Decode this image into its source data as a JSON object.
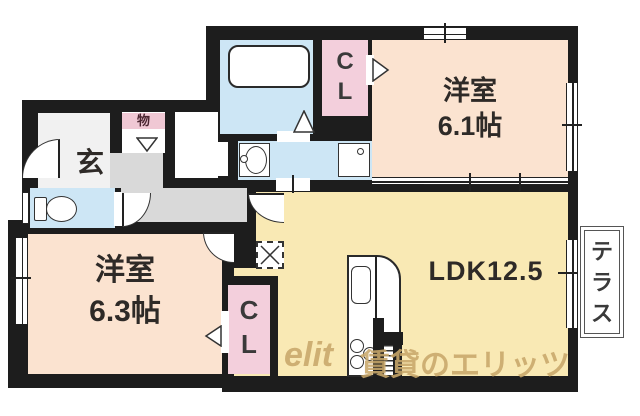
{
  "floorplan": {
    "rooms": {
      "western1": {
        "label": "洋室",
        "size": "6.1帖"
      },
      "western2": {
        "label": "洋室",
        "size": "6.3帖"
      },
      "ldk": {
        "label": "LDK12.5"
      },
      "entrance": {
        "label": "玄"
      },
      "storage": {
        "label": "物"
      },
      "closet_top": {
        "line1": "C",
        "line2": "L"
      },
      "closet_bottom": {
        "line1": "C",
        "line2": "L"
      },
      "terrace": {
        "c1": "テ",
        "c2": "ラ",
        "c3": "ス"
      }
    },
    "watermark": {
      "logo": "elit",
      "text": "賃貸のエリッツ"
    },
    "colors": {
      "wall": "#1d1d1d",
      "western_room": "#fbe3d0",
      "ldk_room": "#f9e9b4",
      "wet_area": "#cde6f5",
      "closet": "#f3cfdc",
      "hallway": "#d9d9d9",
      "watermark": "#c9a86b"
    }
  }
}
